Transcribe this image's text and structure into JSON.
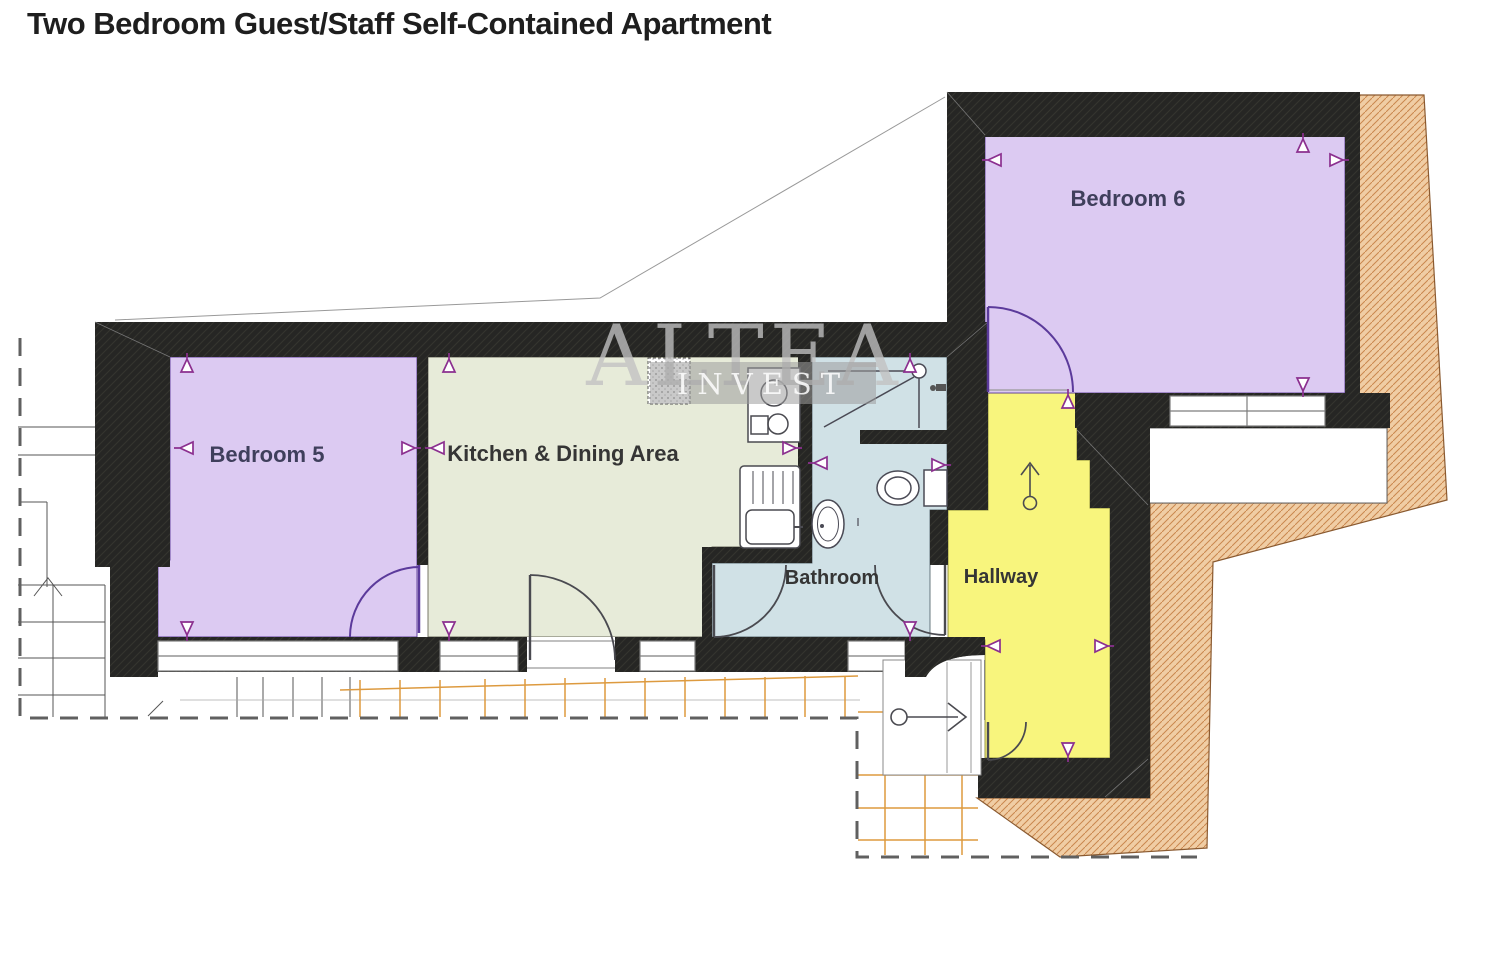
{
  "title": "Two Bedroom Guest/Staff Self-Contained Apartment",
  "watermark": {
    "line1": "ALTEA",
    "line2": "INVEST"
  },
  "rooms": {
    "bedroom5": {
      "label": "Bedroom 5",
      "color": "#dccaf2"
    },
    "kitchen": {
      "label": "Kitchen & Dining Area",
      "color": "#e7ebd9"
    },
    "bathroom": {
      "label": "Bathroom",
      "color": "#d0e1e6"
    },
    "hallway": {
      "label": "Hallway",
      "color": "#f8f57d"
    },
    "bedroom6": {
      "label": "Bedroom 6",
      "color": "#dccaf2"
    }
  },
  "palette": {
    "wall": "#262624",
    "terrace_fill": "#f0cda4",
    "terrace_hatch": "#c9874e",
    "trellis": "#dd9a3f",
    "marker": "#8b2f8f",
    "door_bedroom": "#5b3a9b",
    "door_other": "#4a4a50",
    "boundary_dash": "#606060",
    "label_dark": "#3f3f5c",
    "label_neutral": "#353535",
    "watermark_gray": "#c2c2c2"
  }
}
